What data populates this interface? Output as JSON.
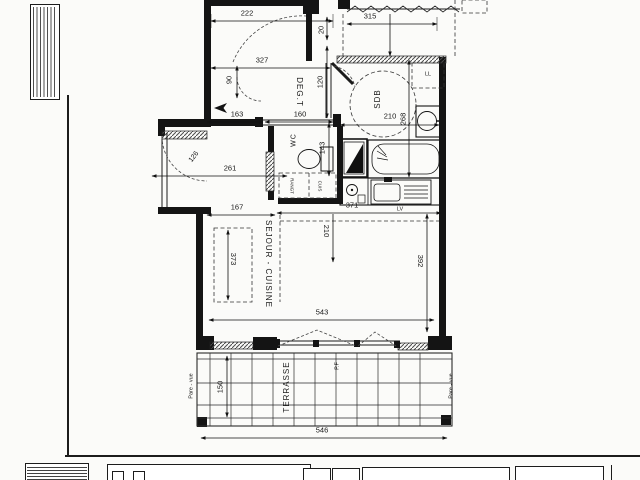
{
  "plan": {
    "rooms": {
      "degt": "DEG.T",
      "wc": "WC",
      "sdb": "SDB",
      "sejour_cuisine": "SEJOUR - CUISINE",
      "terrasse": "TERRASSE"
    },
    "fixtures": {
      "washing_machine": "LL",
      "dishwasher": "LV",
      "french_door": "P.F",
      "storage": "RANGT",
      "kitchen_strip": "CUIS"
    },
    "screens": {
      "left": "Pare - vue",
      "right": "Pare - vue"
    },
    "dims": {
      "top_222": "222",
      "top_315": "315",
      "degt_327": "327",
      "door_20": "20",
      "degt_120": "120",
      "degt_90": "90",
      "wall_163": "163",
      "wall_160": "160",
      "sdb_210": "210",
      "sdb_268": "268",
      "wc_143": "143",
      "entry_126": "126",
      "entry_261": "261",
      "sejour_167": "167",
      "kitchen_371": "371",
      "sejour_210": "210",
      "sejour_373": "373",
      "sejour_392": "392",
      "sejour_543": "543",
      "terrasse_150": "150",
      "terrasse_546": "546"
    }
  }
}
